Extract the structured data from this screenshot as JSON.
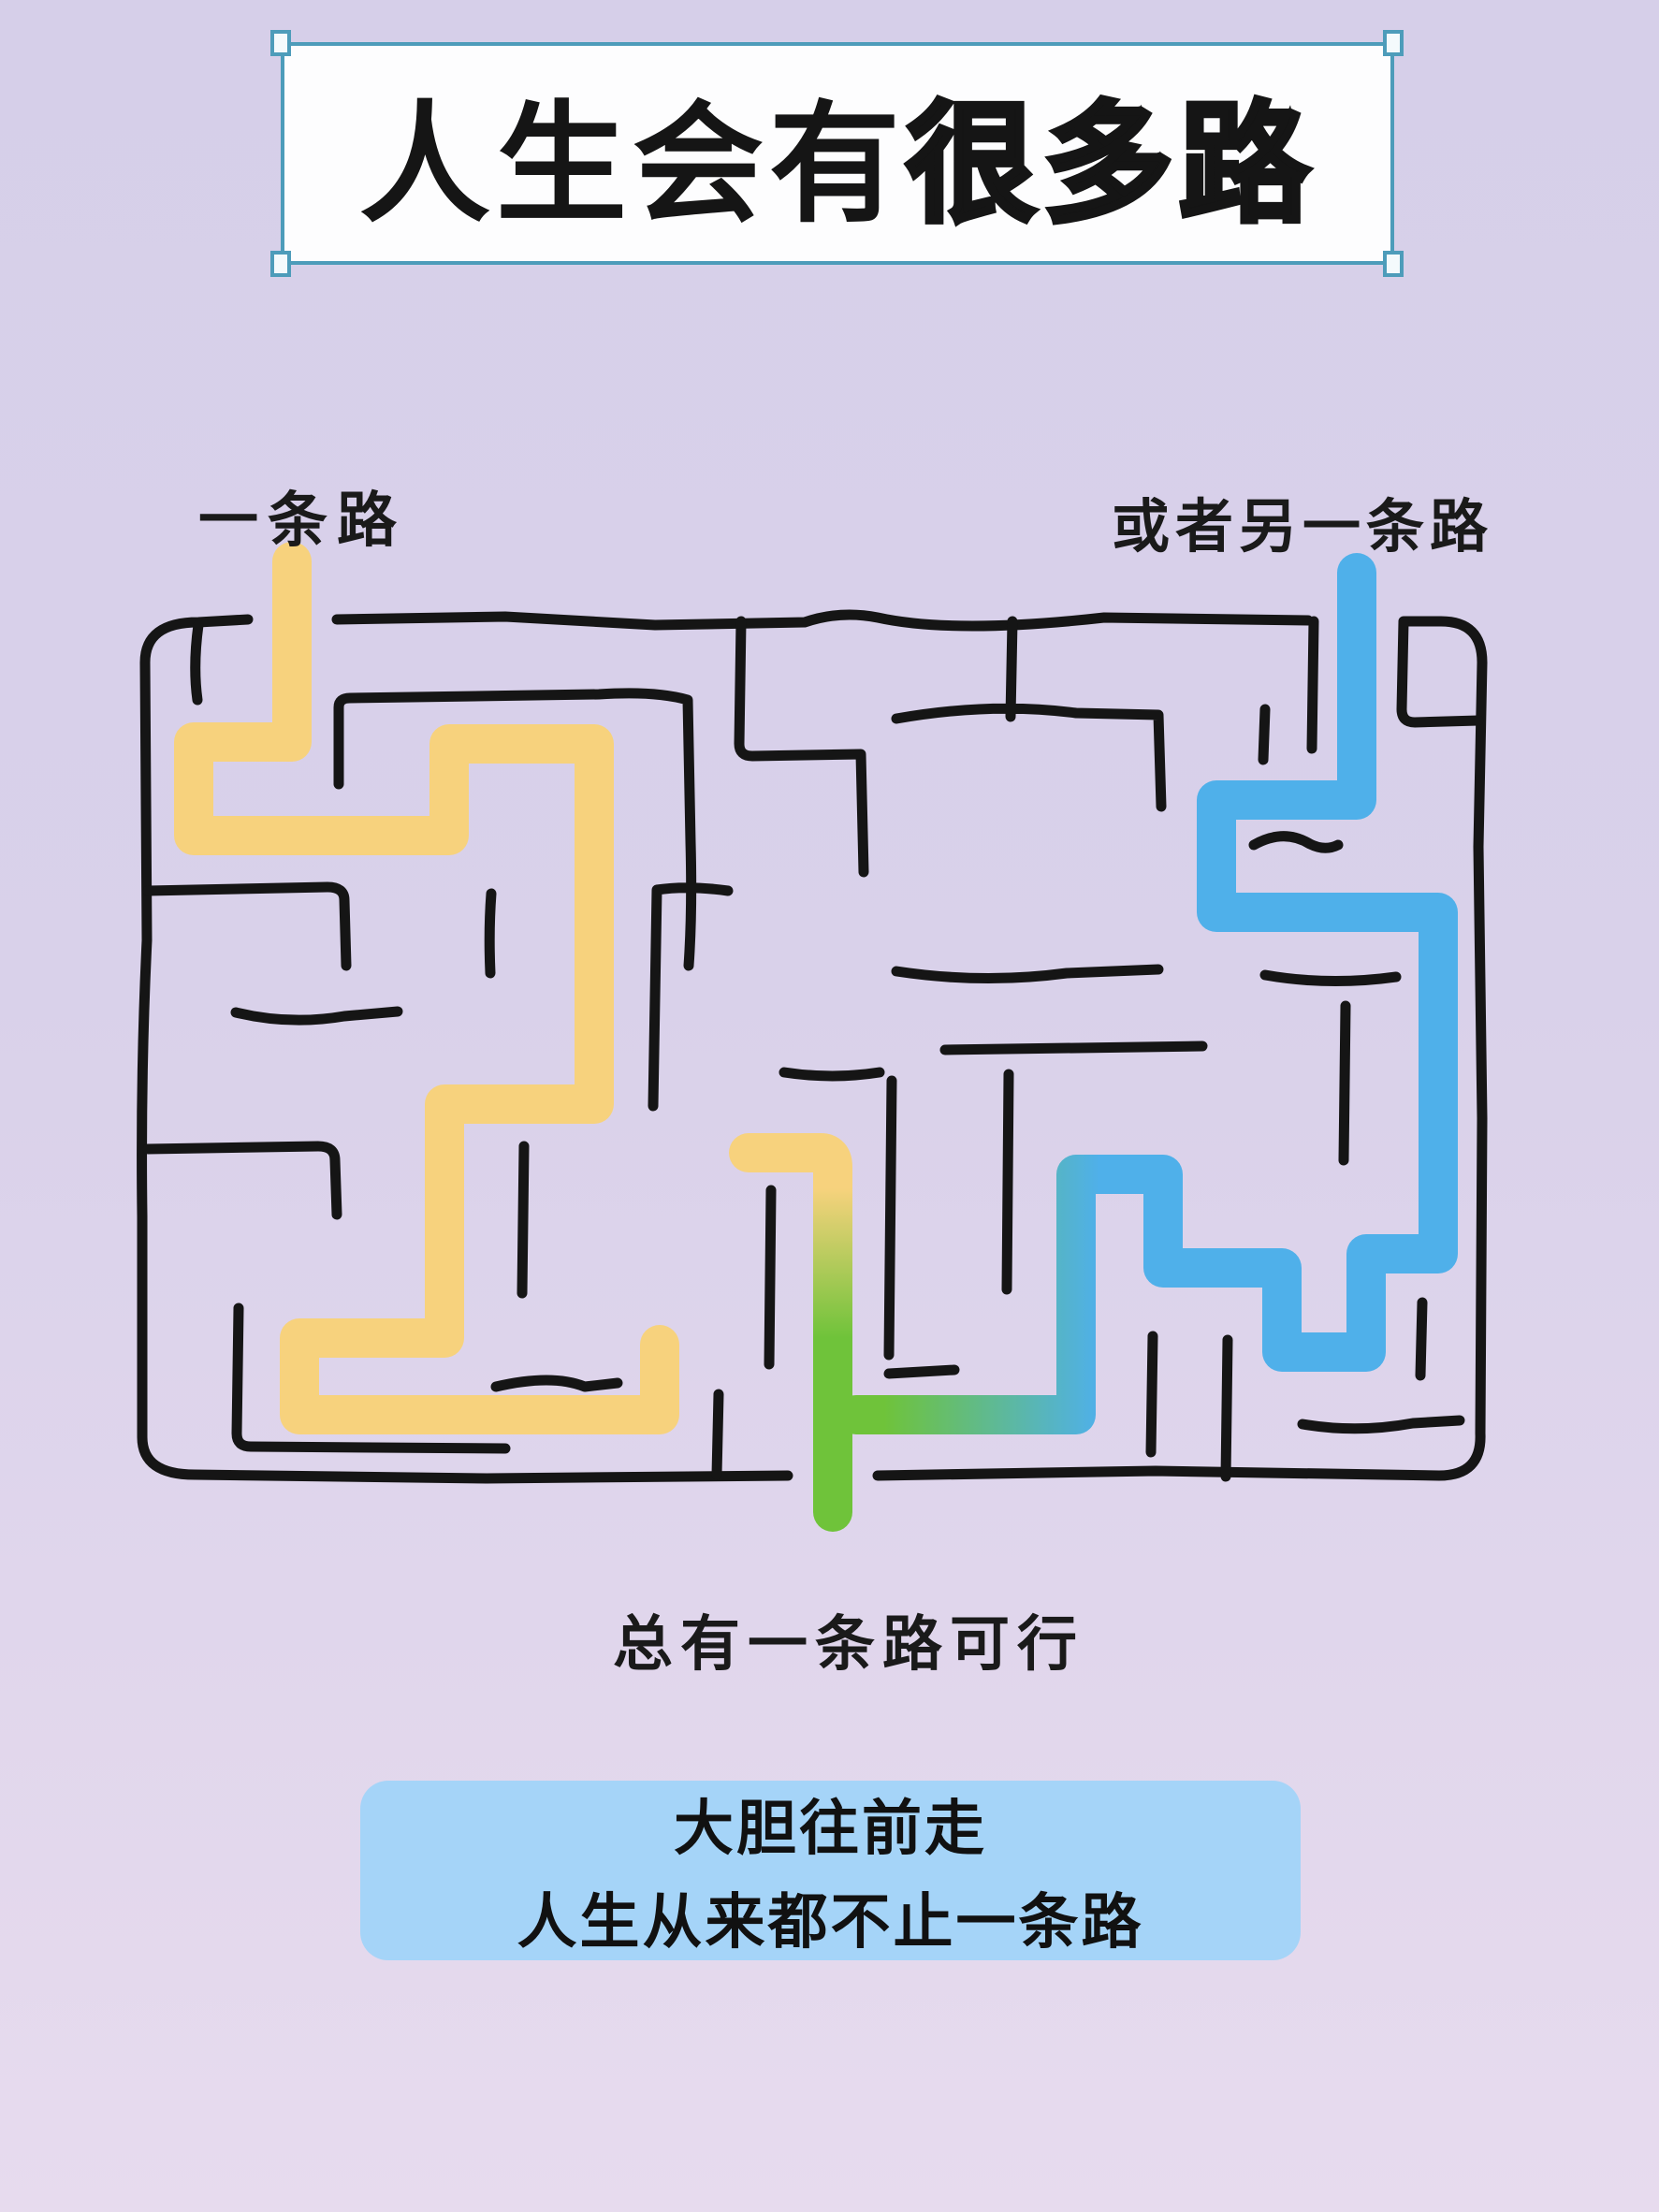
{
  "title": {
    "regular": "人生会有",
    "emphasis": "很多路"
  },
  "maze_labels": {
    "left_path": "一条路",
    "right_path": "或者另一条路",
    "exit_path": "总有一条路可行"
  },
  "footer": {
    "line1": "大胆往前走",
    "line2": "人生从来都不止一条路"
  },
  "colors": {
    "background": "#d7cfe9",
    "background_bottom": "#e7dbee",
    "wall": "#151515",
    "path_left": "#f7d27d",
    "path_right": "#4fb0ea",
    "path_exit": "#6fc33a",
    "title_border": "#4d9cba",
    "title_background": "#fdfdfe",
    "footer_background": "#a5d4f8",
    "text": "#151515"
  }
}
